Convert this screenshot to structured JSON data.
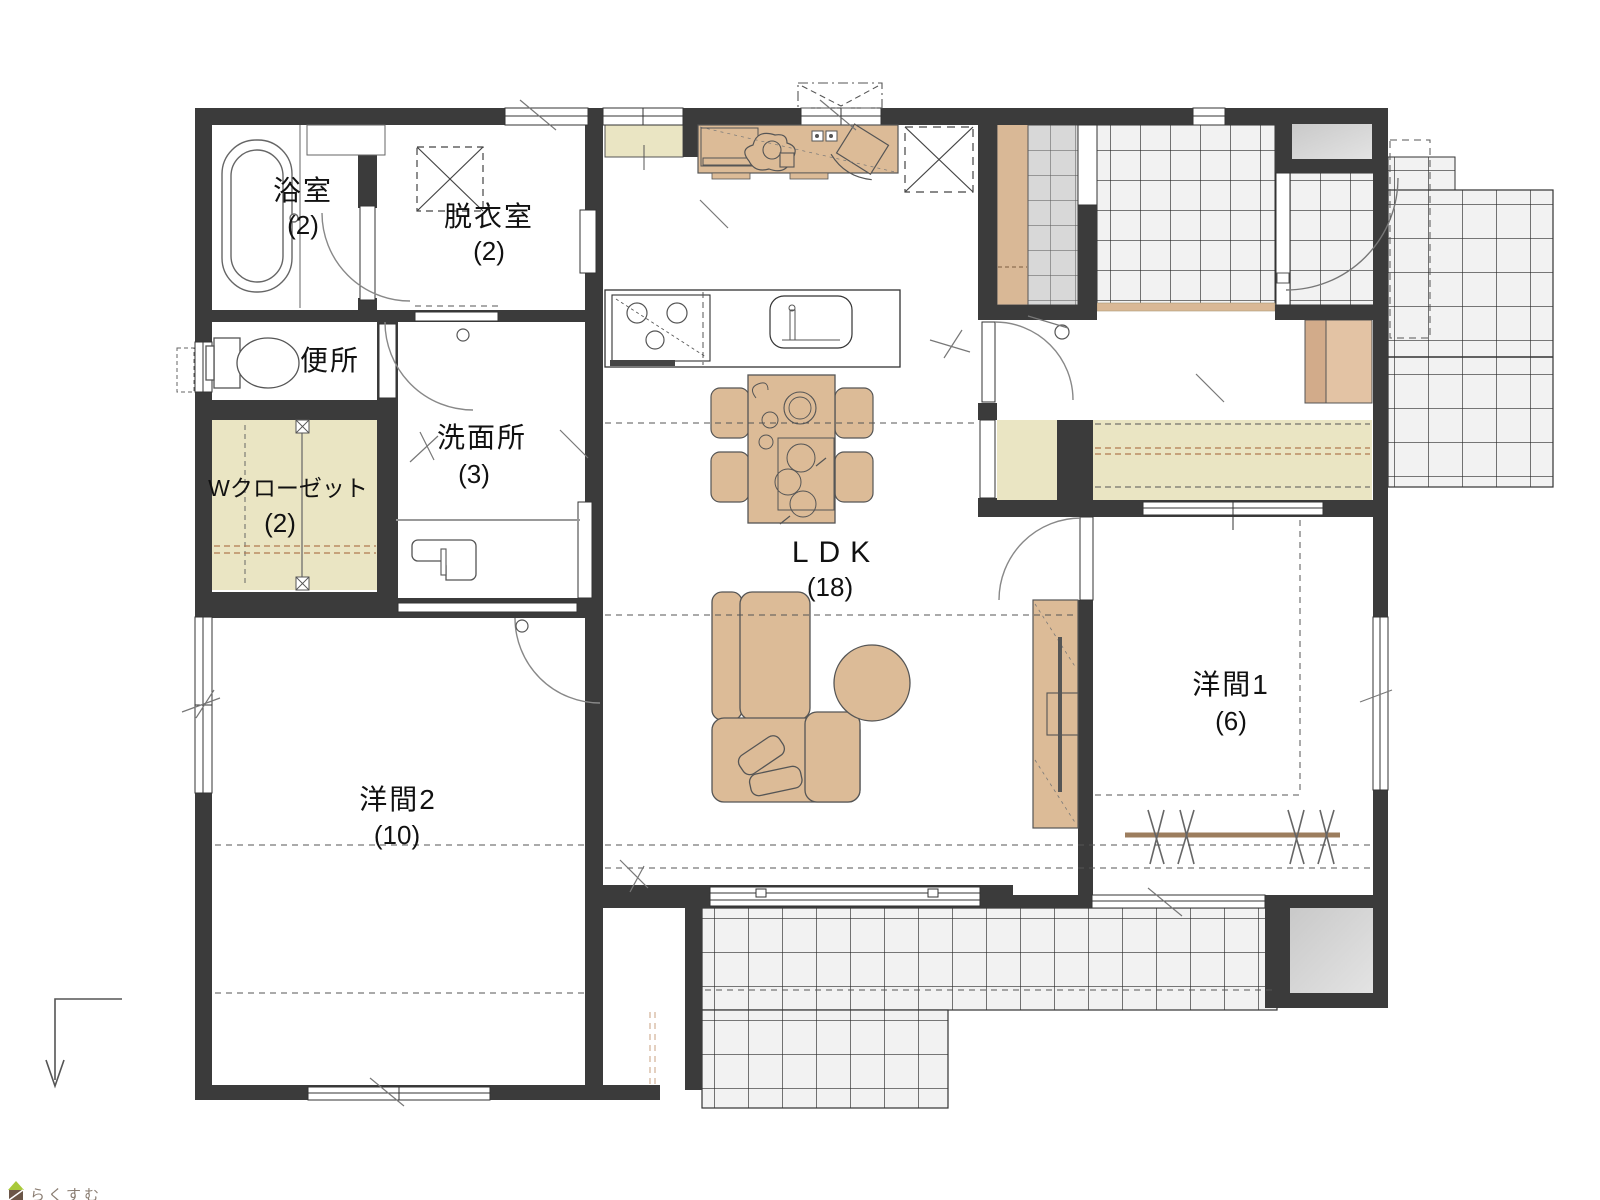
{
  "title": "1LDK+2洋室 平面図",
  "colors": {
    "wall": "#3b3b3b",
    "furniture_tan": "#dcbb97",
    "closet_khaki": "#eae5c3",
    "shoe_cabinet_tan": "#d9b896",
    "tile_light": "#f2f2f2",
    "tile_gray": "#d8d8d8",
    "pad_gray": "#d2d2d2",
    "outline": "#333333",
    "arc": "#888888",
    "logo_green": "#a9c93a",
    "logo_brown": "#6b5648",
    "logo_text": "#8a7d72"
  },
  "rooms": [
    {
      "id": "bath",
      "name": "浴室",
      "size": "(2)"
    },
    {
      "id": "dressing",
      "name": "脱衣室",
      "size": "(2)"
    },
    {
      "id": "toilet",
      "name": "便所",
      "size": ""
    },
    {
      "id": "wcloset",
      "name": "Wクローゼット",
      "size": "(2)"
    },
    {
      "id": "washroom",
      "name": "洗面所",
      "size": "(3)"
    },
    {
      "id": "ldk",
      "name": "LDK",
      "size": "(18)"
    },
    {
      "id": "room1",
      "name": "洋間1",
      "size": "(6)"
    },
    {
      "id": "room2",
      "name": "洋間2",
      "size": "(10)"
    }
  ],
  "logo": {
    "text": "らくすむ"
  }
}
